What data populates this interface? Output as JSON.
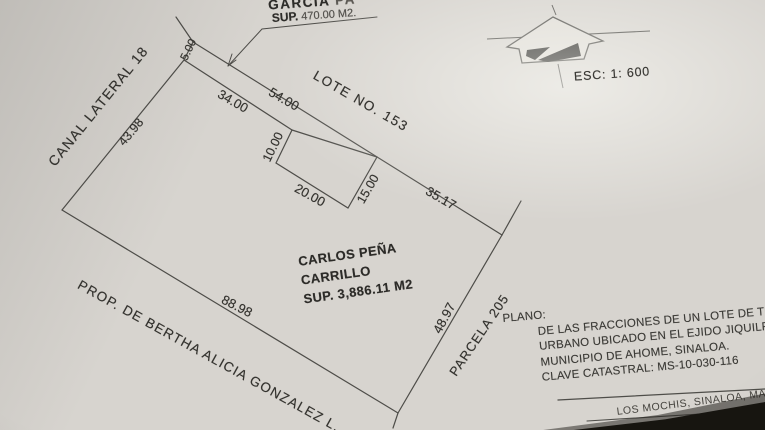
{
  "photo": {
    "garcia": {
      "name": "GARCIA",
      "name_faint": " PA",
      "sup_label": "SUP.",
      "sup_value": " 470.00 M2."
    },
    "north": {
      "esc": "ESC: 1: 600"
    },
    "plan": {
      "lote": "LOTE NO. 153",
      "canal": "CANAL LATERAL 18",
      "prop": "PROP. DE BERTHA ALICIA GONZALEZ L.",
      "parcela": "PARCELA 205",
      "owner_line1": "CARLOS PEÑA",
      "owner_line2": "CARRILLO",
      "owner_sup": "SUP. 3,886.11 M2",
      "dims": {
        "d5": "5.00",
        "d34": "34.00",
        "d54": "54.00",
        "d3517": "35.17",
        "d4398": "43.98",
        "d8898": "88.98",
        "d4897": "48.97",
        "d10": "10.00",
        "d20": "20.00",
        "d15": "15.00"
      }
    },
    "title_block": {
      "plano": "PLANO:",
      "l1": "DE LAS FRACCIONES DE UN LOTE DE TER",
      "l2": "URBANO UBICADO EN EL EJIDO JIQUILPA",
      "l3": "MUNICIPIO DE AHOME, SINALOA.",
      "l4": "CLAVE CATASTRAL: MS-10-030-116",
      "footer": "LOS MOCHIS, SINALOA, MAYO DE"
    },
    "colors": {
      "paper": "#d7d4cf",
      "ink": "#4b4a46",
      "shadow": "#171510"
    }
  }
}
